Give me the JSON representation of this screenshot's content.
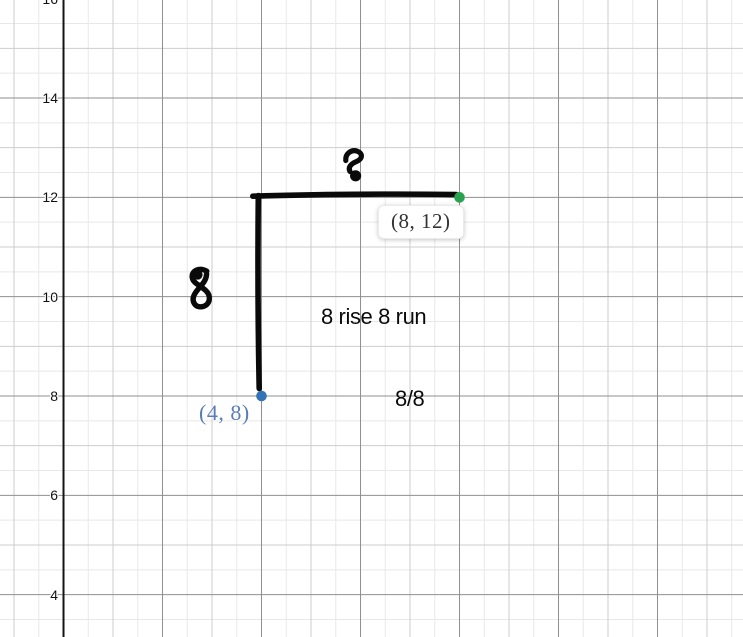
{
  "colors": {
    "background": "#ffffff",
    "grid_half_line": "#e8e8e8",
    "grid_unit_line": "#cdcdcd",
    "grid_major_line": "#8f8f8f",
    "axis_line": "#141414",
    "ink_black": "#0a0a0a",
    "point_blue": "#3273b5",
    "point_blue_label": "#5a7db4",
    "point_green": "#29a24f",
    "boxed_label_text": "#333333"
  },
  "chart_data": {
    "type": "scatter",
    "title": "",
    "xlabel": "",
    "ylabel": "",
    "axes": {
      "x_visible_range": [
        -1.283,
        13.727
      ],
      "y_visible_range": [
        3.148,
        15.973
      ],
      "y_tick_values": [
        16,
        14,
        12,
        10,
        8,
        6,
        4
      ],
      "y_tick_labels": [
        "16",
        "14",
        "12",
        "10",
        "8",
        "6",
        "4"
      ],
      "x_tick_labels": [],
      "label_step": 2,
      "unit_step": 1,
      "minor_step": 0.5,
      "grid": true,
      "legend": "none"
    },
    "points": [
      {
        "x": 4,
        "y": 8,
        "label": "(4, 8)",
        "color": "#3273b5",
        "label_style": "plain-blue"
      },
      {
        "x": 8,
        "y": 12,
        "label": "(8, 12)",
        "color": "#29a24f",
        "label_style": "white-box"
      }
    ],
    "rise_run_triangle": {
      "rise_segment": {
        "from": [
          4,
          12
        ],
        "to": [
          4,
          8
        ]
      },
      "run_segment": {
        "from": [
          4,
          12
        ],
        "to": [
          8,
          12
        ]
      },
      "rise_value": 8,
      "run_value": 8,
      "slope": "8/8"
    },
    "text_annotations": [
      {
        "text": "8 rise 8 run",
        "near": [
          6.2,
          9.6
        ]
      },
      {
        "text": "8/8",
        "near": [
          7,
          8
        ]
      }
    ],
    "ink": {
      "strokes": [
        {
          "name": "rise-stroke-vertical",
          "width": 5.6,
          "d": "M 258.3 195.5 C 257.8 250 258 330 259.2 388.5"
        },
        {
          "name": "run-stroke-horizontal",
          "width": 5.6,
          "d": "M 252.8 196.2 C 310 194.2 400 193.6 456.3 194.6"
        },
        {
          "name": "handwritten-8-run",
          "width": 5.2,
          "d": "M 345.8 160.5 C 345.2 153.5 351.5 149.2 357.2 151.2 C 362.8 153.2 363 158.8 356.5 161.5 C 350.5 164 347.8 167.5 350 171.5",
          "blobs": [
            [
              355.6,
              175.8,
              5.6
            ]
          ]
        },
        {
          "name": "handwritten-8-rise",
          "width": 5.4,
          "d": "M 206.8 271.2 C 199.5 267 191.5 270.5 192.2 277.2 C 192.8 283.2 200.2 285.2 205.8 290.6 C 211.5 296 210.3 304.8 202.6 306.6 C 195.2 308.3 190.6 301 194.8 293.8 C 199 286.6 206.4 282.4 206.6 273.8",
          "blobs": [
            [
              197.8,
              274.8,
              4.8
            ]
          ]
        }
      ]
    }
  }
}
